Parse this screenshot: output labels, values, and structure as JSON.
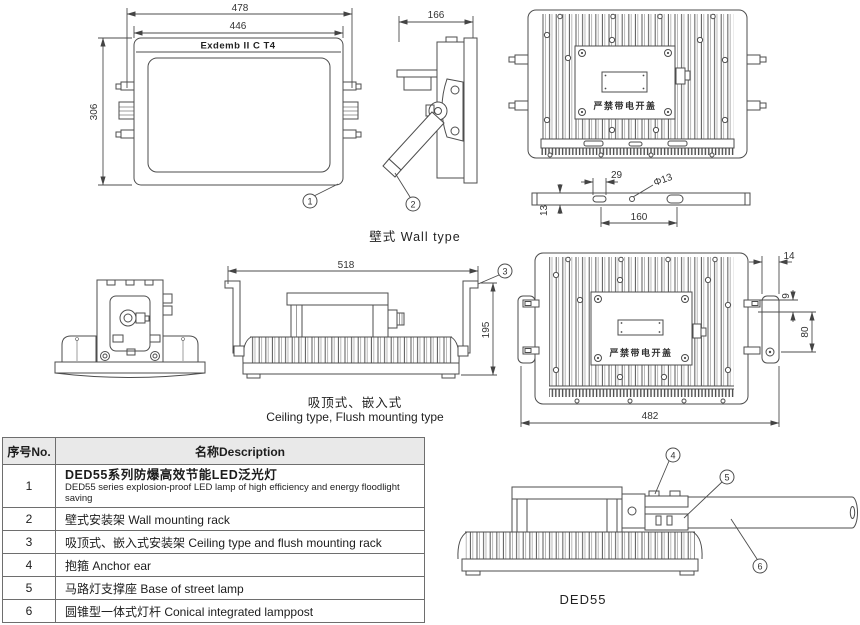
{
  "drawing": {
    "front_view": {
      "marking": "Exdemb II C T4",
      "dim_outer_width": "478",
      "dim_body_width": "446",
      "dim_height": "306",
      "callout": "1"
    },
    "wall_side_view": {
      "dim_depth": "166",
      "callout": "2",
      "caption": "壁式  Wall type"
    },
    "back_view_top": {
      "warning": "严禁带电开盖"
    },
    "mounting_bar": {
      "dim_slot": "29",
      "dim_hole": "Φ13",
      "dim_thickness": "13",
      "dim_spacing": "160"
    },
    "ceiling_view": {
      "dim_width": "518",
      "dim_height": "195",
      "callout": "3",
      "caption_cn": "吸顶式、嵌入式",
      "caption_en": "Ceiling type, Flush mounting type"
    },
    "back_view_bracket": {
      "warning": "严禁带电开盖",
      "dim_tab": "14",
      "dim_gap": "9",
      "dim_bracket": "80",
      "dim_width": "482"
    },
    "street_view": {
      "callout_anchor": "4",
      "callout_base": "5",
      "callout_pole": "6",
      "model": "DED55"
    }
  },
  "table": {
    "header_no": "序号No.",
    "header_desc": "名称Description",
    "rows": [
      {
        "no": "1",
        "cn": "DED55系列防爆高效节能LED泛光灯",
        "en": "DED55 series explosion-proof LED lamp of high efficiency and energy floodlight saving"
      },
      {
        "no": "2",
        "cn": "壁式安装架  Wall mounting rack"
      },
      {
        "no": "3",
        "cn": "吸顶式、嵌入式安装架  Ceiling type and flush mounting rack"
      },
      {
        "no": "4",
        "cn": "抱箍  Anchor ear"
      },
      {
        "no": "5",
        "cn": "马路灯支撑座  Base of street lamp"
      },
      {
        "no": "6",
        "cn": "圆锥型一体式灯杆  Conical integrated lamppost"
      }
    ]
  }
}
